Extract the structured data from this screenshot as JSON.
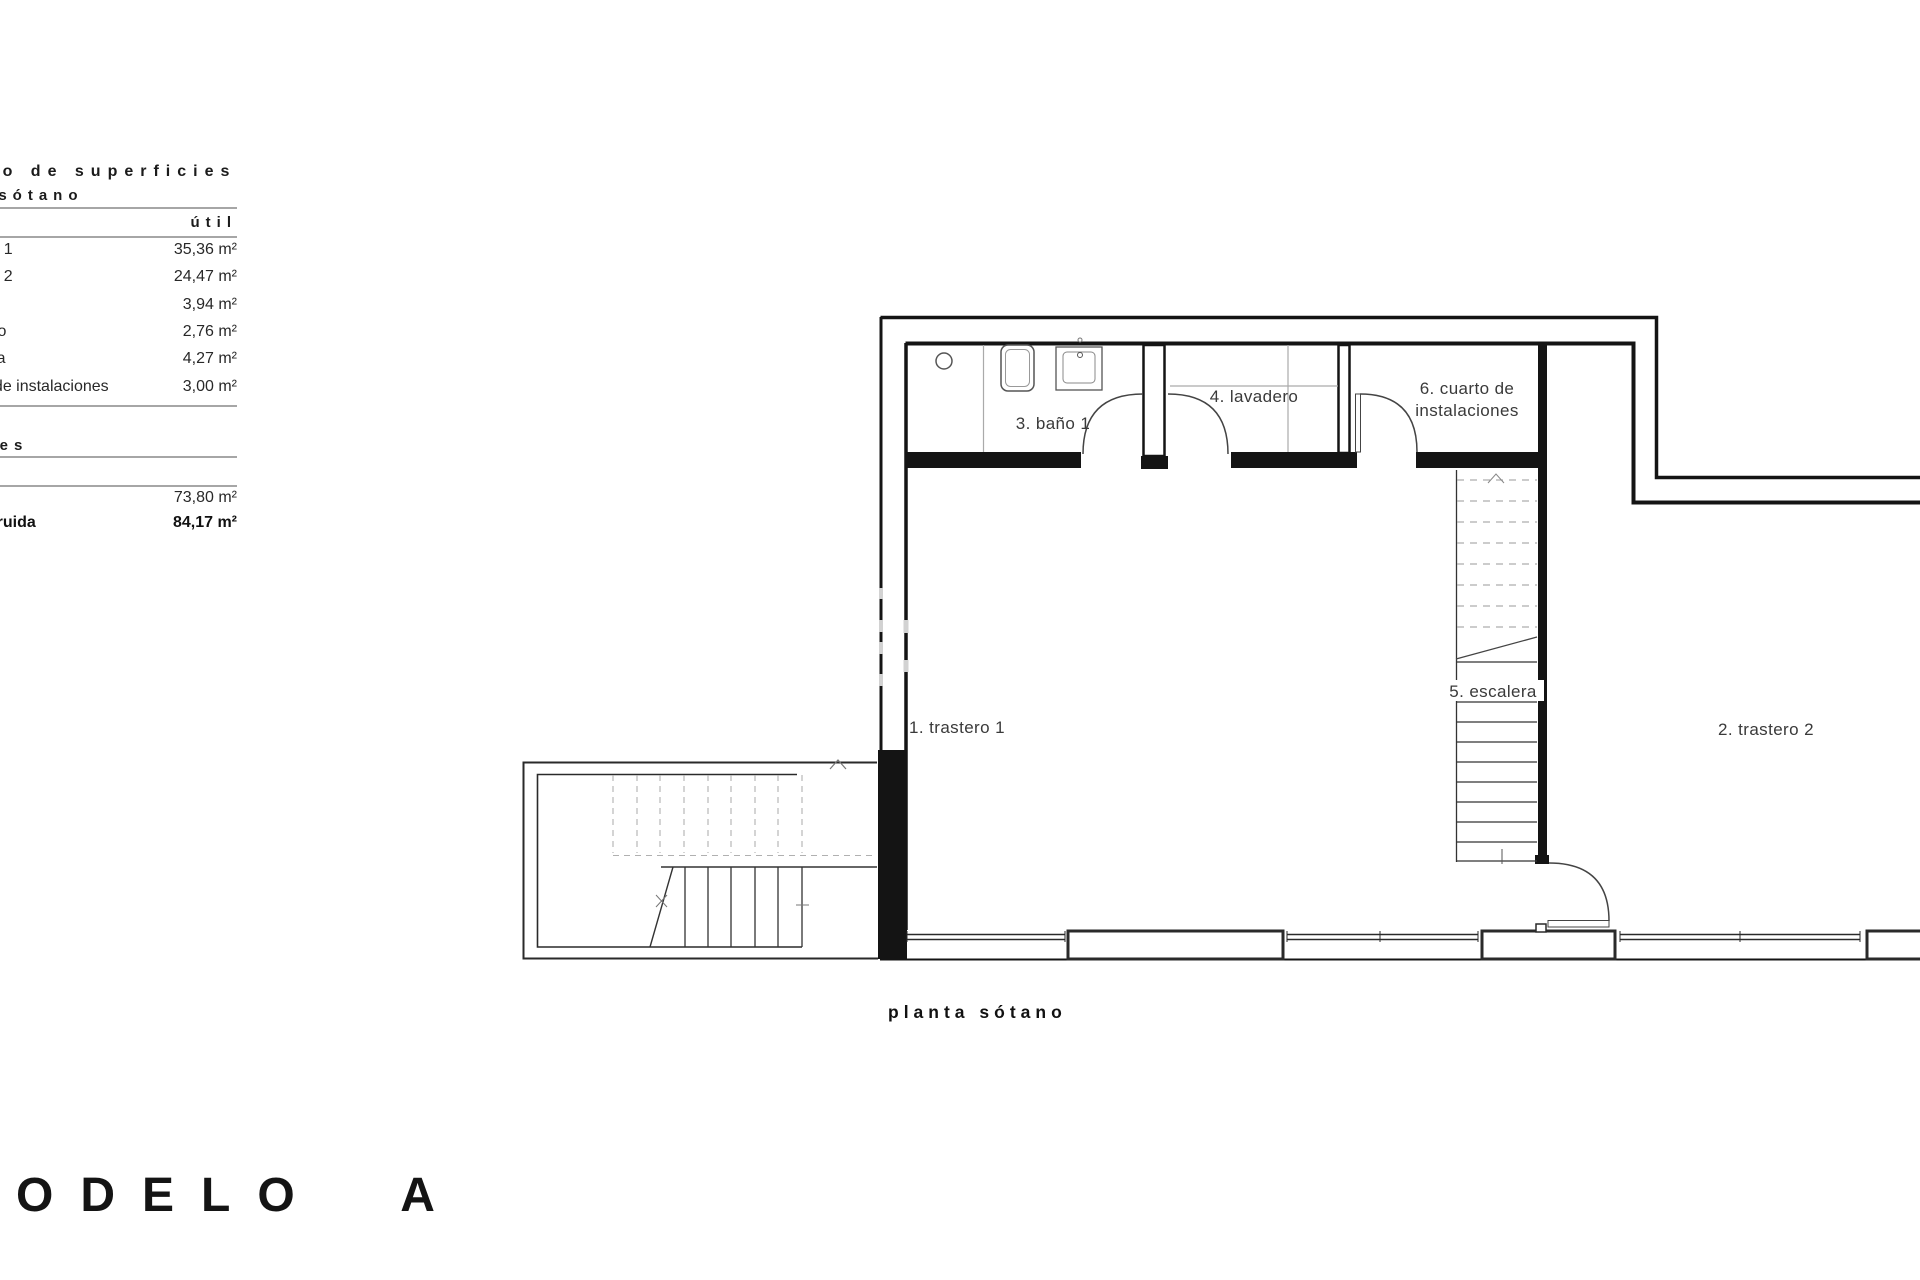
{
  "surface_table": {
    "title": "cuadro de superficies",
    "subtitle": "planta sótano",
    "column_header": "útil",
    "rows": [
      {
        "label": "trastero 1",
        "value": "35,36 m²"
      },
      {
        "label": "trastero 2",
        "value": "24,47 m²"
      },
      {
        "label": "baño 1",
        "value": "3,94 m²"
      },
      {
        "label": "lavadero",
        "value": "2,76 m²"
      },
      {
        "label": "escalera",
        "value": "4,27 m²"
      },
      {
        "label": "cuarto de instalaciones",
        "value": "3,00 m²"
      }
    ],
    "totals_header": "totales",
    "total_util": {
      "label": "",
      "value": "73,80 m²"
    },
    "total_construida": {
      "label": "construida",
      "value": "84,17 m²"
    }
  },
  "plan": {
    "caption": "planta sótano",
    "rooms": {
      "trastero1": {
        "label": "1. trastero 1"
      },
      "trastero2": {
        "label": "2. trastero 2"
      },
      "bano1": {
        "label": "3. baño 1"
      },
      "lavadero": {
        "label": "4. lavadero"
      },
      "escalera": {
        "label": "5. escalera"
      },
      "instalaciones": {
        "label": "6. cuarto de",
        "label2": "instalaciones"
      }
    }
  },
  "footer": {
    "model_title": "MODELO A"
  },
  "colors": {
    "wall": "#141414",
    "thin_line": "#333333",
    "gray_line": "#aaaaaa",
    "rule": "#a6a6a6"
  }
}
